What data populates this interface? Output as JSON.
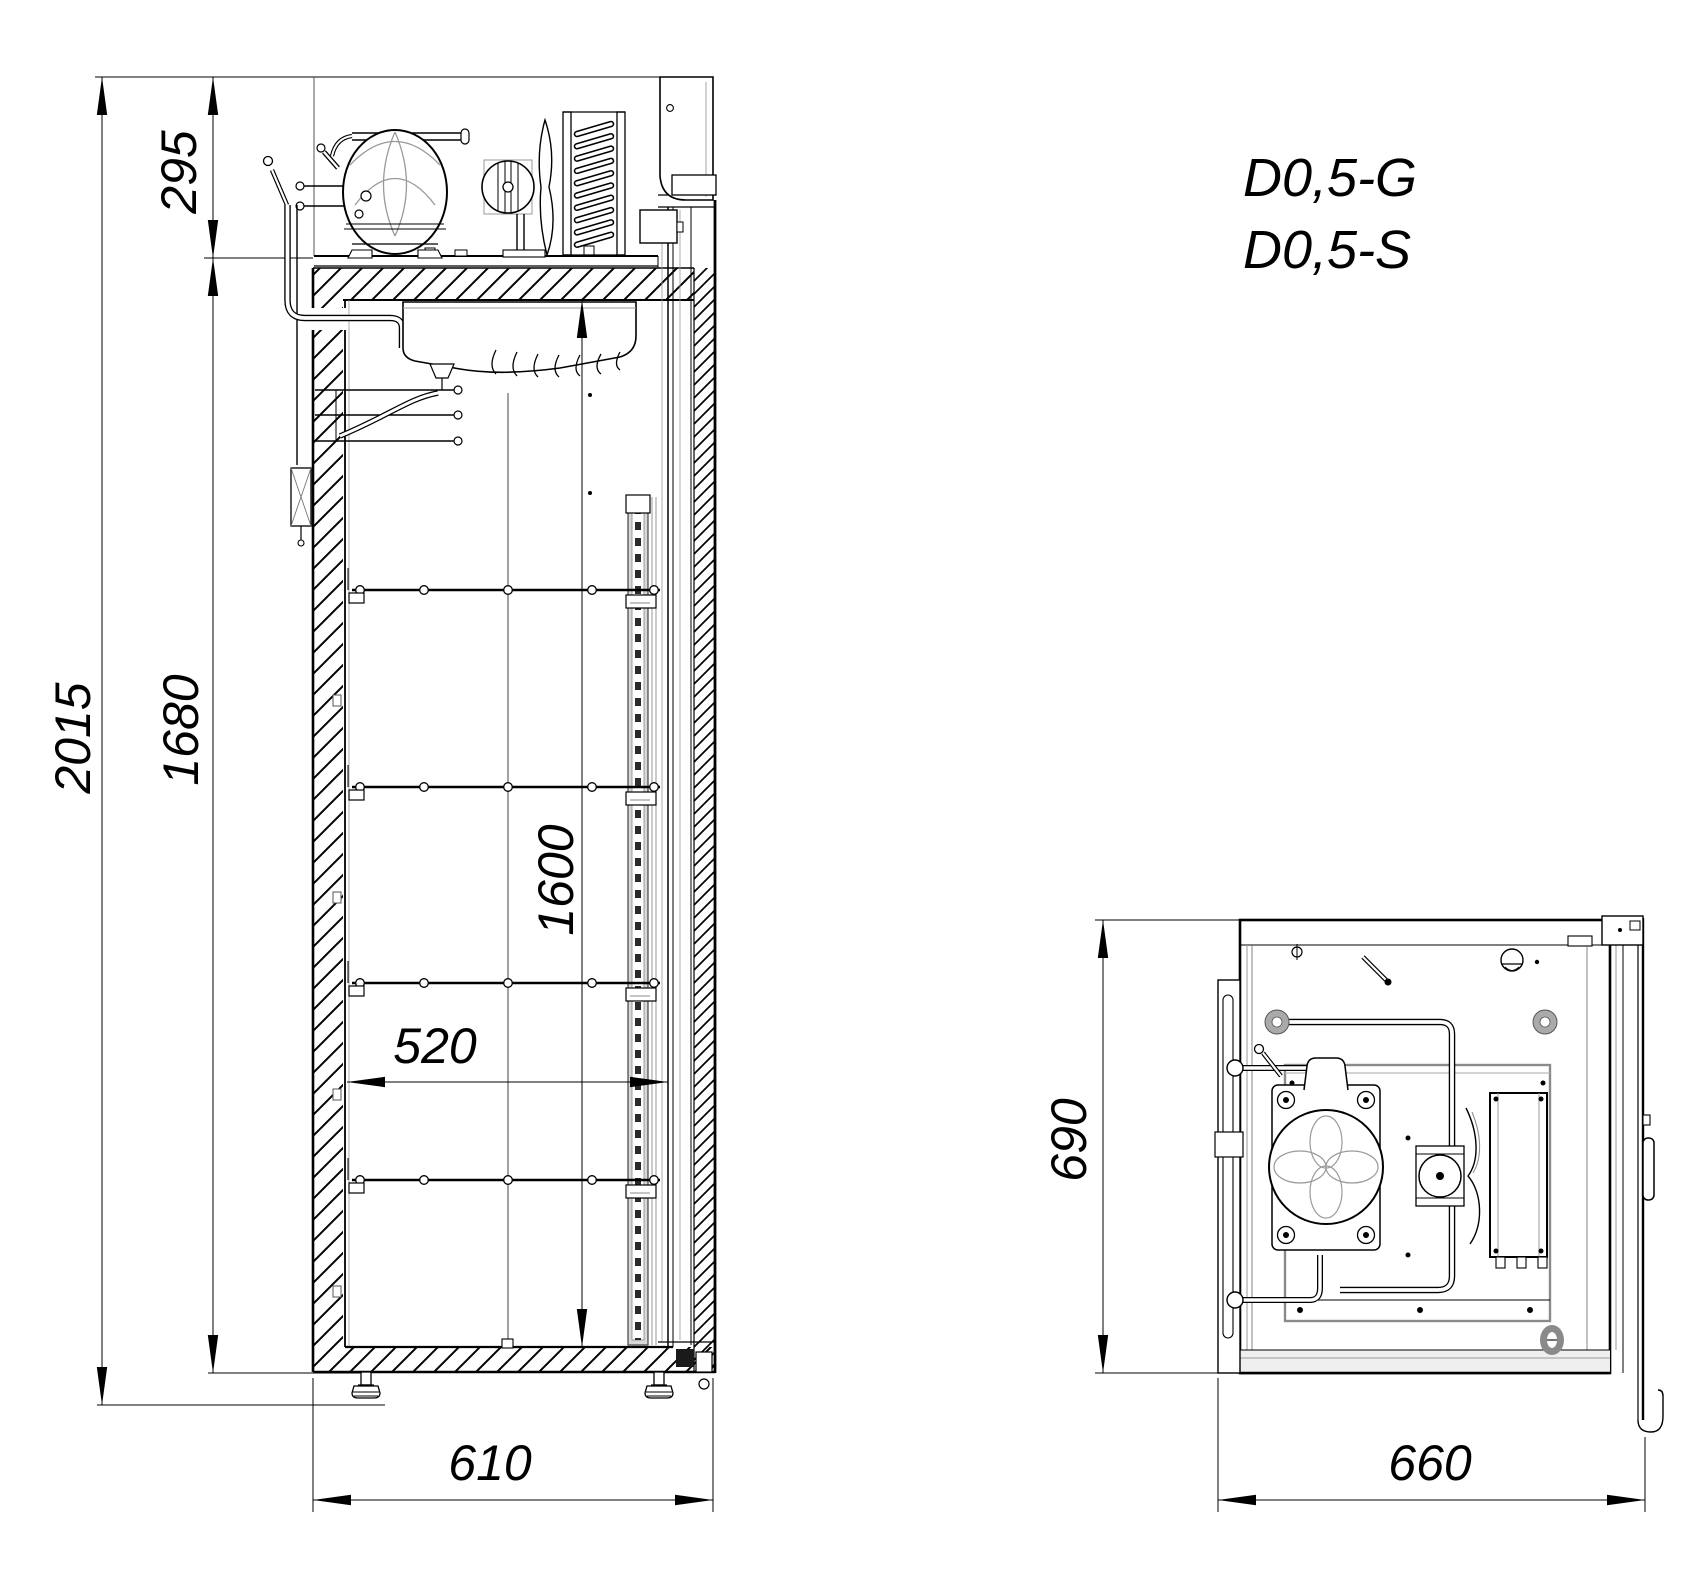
{
  "colors": {
    "line": "#000000",
    "secondary": "#8a8a8a",
    "background": "#ffffff"
  },
  "models": {
    "line1": "D0,5-G",
    "line2": "D0,5-S"
  },
  "side_view": {
    "dims": {
      "total_height": "2015",
      "compartment_height": "295",
      "body_height": "1680",
      "interior_height": "1600",
      "interior_depth": "520",
      "body_depth": "610"
    }
  },
  "top_view": {
    "dims": {
      "width": "690",
      "overall_depth": "660"
    }
  }
}
